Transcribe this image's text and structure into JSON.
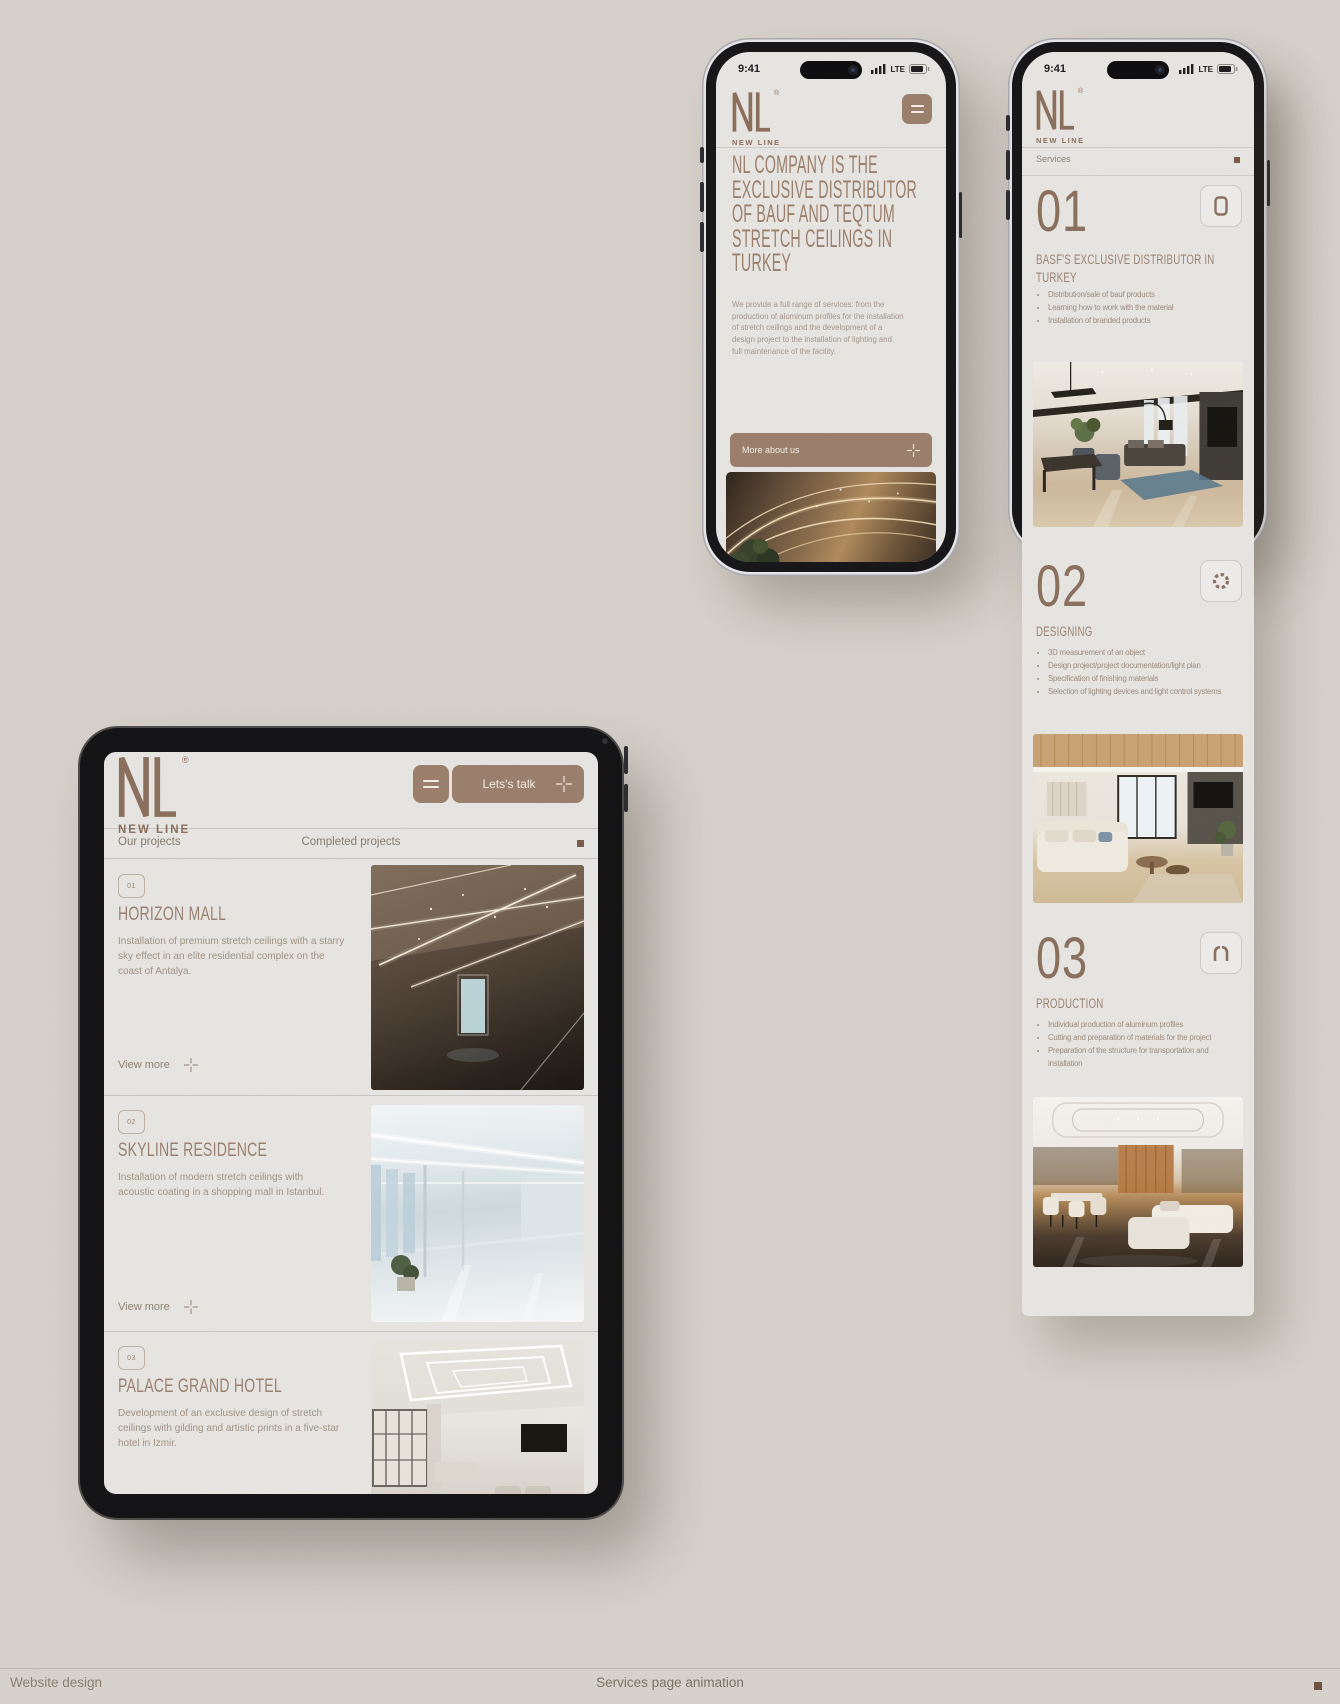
{
  "colors": {
    "background": "#d7d2cb",
    "screen": "#e7e5e2",
    "accent": "#9a7e6b",
    "logo_brown": "#8a6e5c",
    "text_brown": "#9b8070",
    "square_brown": "#7a5a48"
  },
  "brand": {
    "registered": "®",
    "wordmark": "NEW LINE"
  },
  "status": {
    "time": "9:41",
    "network": "LTE"
  },
  "icons": {
    "menu": "hamburger-icon",
    "plus": "plus-icon",
    "signal": "signal-icon",
    "battery": "battery-icon",
    "section_01": "smartphone-icon",
    "section_02": "gear-icon",
    "section_03": "arch-icon"
  },
  "phone1": {
    "heading": "NL COMPANY IS THE EXCLUSIVE DISTRIBUTOR OF BAUF AND TEQTUM STRETCH CEILINGS IN TURKEY",
    "paragraph": "We provide a full range of services: from the production of aluminum profiles for the installation of stretch ceilings and the development of a design project to the installation of lighting and full maintenance of the facility.",
    "cta": "More about us"
  },
  "phone2": {
    "nav": "Services",
    "sections": [
      {
        "number": "01",
        "icon": "smartphone-icon",
        "title": "BASF'S EXCLUSIVE DISTRIBUTOR IN TURKEY",
        "bullets": [
          "Distribution/sale of bauf products",
          "Learning how to work with the material",
          "Installation of branded products"
        ]
      },
      {
        "number": "02",
        "icon": "gear-icon",
        "title": "DESIGNING",
        "bullets": [
          "3D measurement of an object",
          "Design project/project documentation/light plan",
          "Specification of finishing materials",
          "Selection of lighting devices and light control systems"
        ]
      },
      {
        "number": "03",
        "icon": "arch-icon",
        "title": "PRODUCTION",
        "bullets": [
          "Individual production of aluminum profiles",
          "Cutting and preparation of materials for the project",
          "Preparation of the structure for transportation and installation"
        ]
      }
    ]
  },
  "tablet": {
    "cta": "Lets's talk",
    "nav_left": "Our projects",
    "nav_center": "Completed projects",
    "projects": [
      {
        "badge": "01",
        "title": "HORIZON MALL",
        "description": "Installation of premium stretch ceilings with a starry sky effect in an elite residential complex on the coast of Antalya.",
        "link": "View more"
      },
      {
        "badge": "02",
        "title": "SKYLINE RESIDENCE",
        "description": "Installation of modern stretch ceilings with acoustic coating in a shopping mall in Istanbul.",
        "link": "View more"
      },
      {
        "badge": "03",
        "title": "PALACE GRAND HOTEL",
        "description": "Development of an exclusive design of stretch ceilings with gilding and artistic prints in a five-star hotel in Izmir."
      }
    ]
  },
  "footer": {
    "left": "Website design",
    "center": "Services page animation"
  }
}
